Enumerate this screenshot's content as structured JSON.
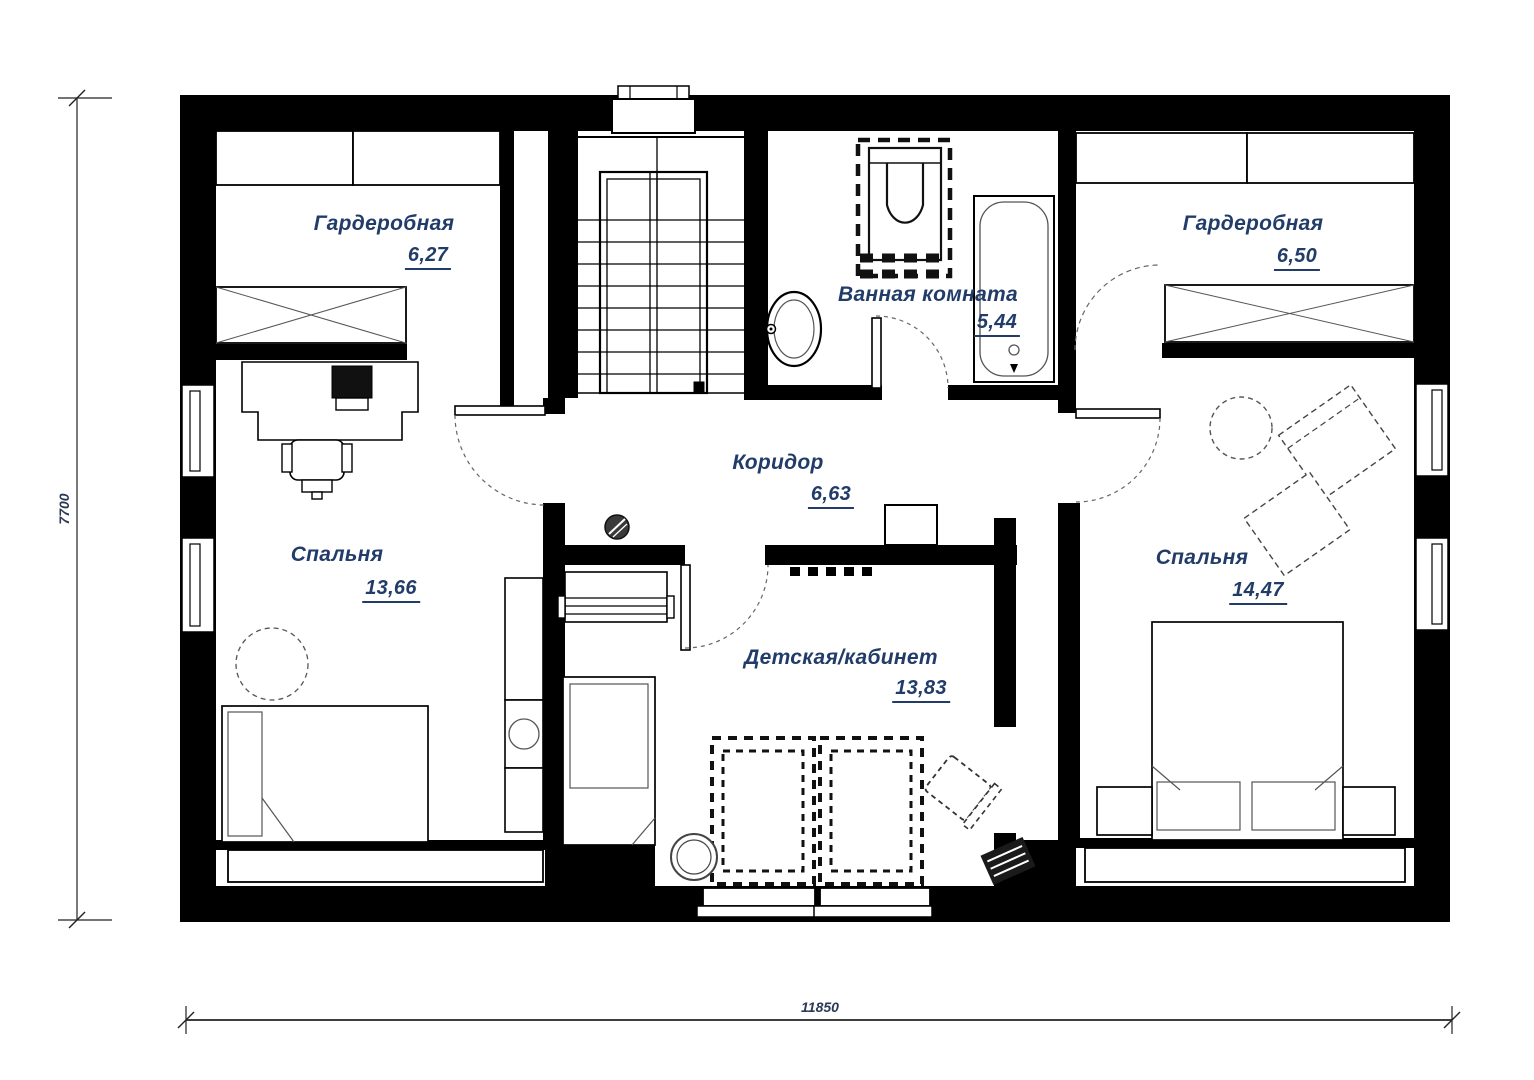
{
  "plan": {
    "rooms": [
      {
        "name": "Гардеробная",
        "area": "6,27"
      },
      {
        "name": "Ванная комната",
        "area": "5,44"
      },
      {
        "name": "Гардеробная",
        "area": "6,50"
      },
      {
        "name": "Коридор",
        "area": "6,63"
      },
      {
        "name": "Спальня",
        "area": "13,66"
      },
      {
        "name": "Детская/кабинет",
        "area": "13,83"
      },
      {
        "name": "Спальня",
        "area": "14,47"
      }
    ],
    "dimensions": {
      "width_mm": "11850",
      "height_mm": "7700"
    },
    "colors": {
      "wall": "#000000",
      "label": "#223c69",
      "furniture_stroke": "#444444"
    }
  }
}
